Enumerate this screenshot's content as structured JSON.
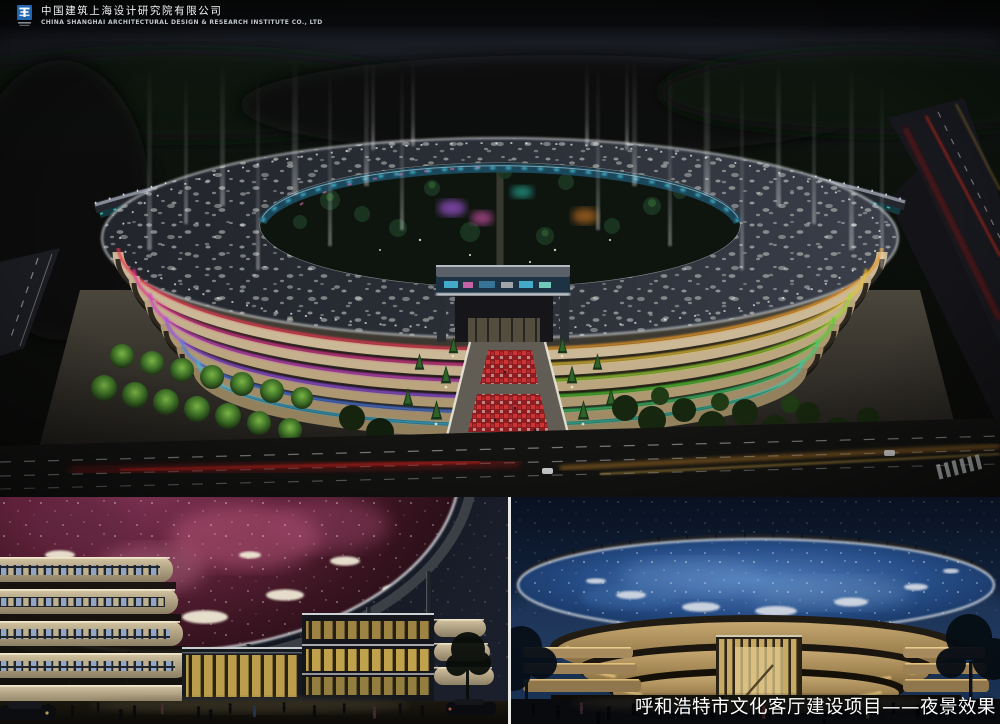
{
  "header": {
    "company_name_cn": "中国建筑上海设计研究院有限公司",
    "company_name_en": "CHINA SHANGHAI ARCHITECTURAL DESIGN & RESEARCH INSTITUTE CO., LTD"
  },
  "caption": {
    "text": "呼和浩特市文化客厅建设项目——夜景效果"
  },
  "colors": {
    "logo_blue": "#2066b0",
    "caption_text": "#ffffff",
    "facade_neon_left": [
      "#e8394f",
      "#e23a90",
      "#cf46c9",
      "#9a52e8",
      "#4f7ee8",
      "#38bce8"
    ],
    "facade_neon_right": [
      "#e89828",
      "#e8c33a",
      "#9ed832",
      "#52cd30",
      "#3ecf6e",
      "#36c9b0"
    ],
    "dome_nebula_pink": "#8a2f55",
    "dome_starry_blue": "#2a5391"
  }
}
